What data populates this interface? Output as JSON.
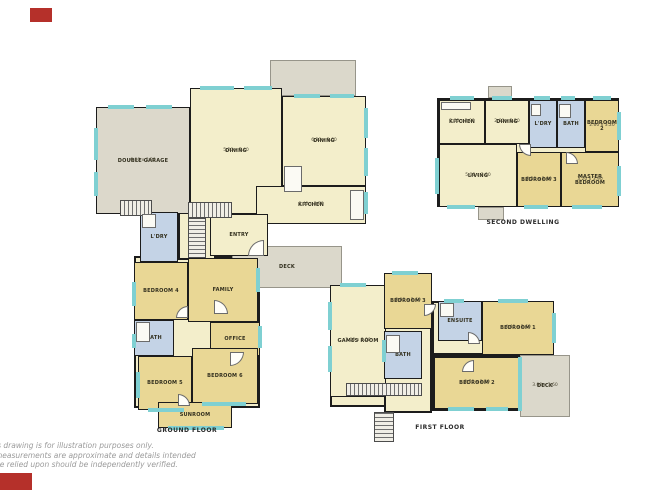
{
  "colors": {
    "wall": "#1c1c1c",
    "living": "#f3eecb",
    "bed": "#e9d795",
    "wet": "#c4d3e6",
    "garage": "#dcd8cb",
    "deck": "#dbd8cb",
    "window": "#7fd0d2",
    "brand": "#b5302a"
  },
  "disclaimer": {
    "line1": "is drawing is for illustration purposes only.",
    "line2": "measurements are approximate and details intended",
    "line3": "be relied upon should be independently verified."
  },
  "plans": {
    "ground": {
      "caption": "GROUND FLOOR",
      "base": [
        [
          134,
          256,
          126,
          152
        ],
        [
          178,
          212,
          38,
          48
        ]
      ],
      "rooms": [
        {
          "type": "deck",
          "rect": [
            270,
            60,
            86,
            36
          ]
        },
        {
          "label": "DECK",
          "type": "deck",
          "rect": [
            232,
            246,
            110,
            42
          ]
        },
        {
          "label": "DOUBLE GARAGE",
          "dims": "6.00 x 8.20",
          "type": "garage",
          "rect": [
            96,
            107,
            94,
            107
          ]
        },
        {
          "label": "DINING",
          "dims": "5.20 x 7.40",
          "type": "living",
          "rect": [
            190,
            88,
            92,
            126
          ]
        },
        {
          "label": "DINING",
          "dims": "6.30 x 3.60",
          "type": "living",
          "rect": [
            282,
            96,
            84,
            90
          ]
        },
        {
          "label": "KITCHEN",
          "dims": "6.40 x 3.70",
          "type": "living",
          "rect": [
            256,
            186,
            110,
            38
          ]
        },
        {
          "label": "ENTRY",
          "type": "living",
          "rect": [
            210,
            214,
            58,
            42
          ]
        },
        {
          "label": "L'DRY",
          "type": "wet",
          "rect": [
            140,
            212,
            38,
            50
          ]
        },
        {
          "label": "BEDROOM 4",
          "type": "bed",
          "rect": [
            134,
            262,
            54,
            58
          ]
        },
        {
          "label": "FAMILY",
          "type": "bed",
          "rect": [
            188,
            258,
            70,
            64
          ]
        },
        {
          "label": "BATH",
          "type": "wet",
          "rect": [
            134,
            320,
            40,
            36
          ]
        },
        {
          "label": "OFFICE",
          "type": "bed",
          "rect": [
            210,
            322,
            50,
            34
          ]
        },
        {
          "label": "BEDROOM 5",
          "type": "bed",
          "rect": [
            138,
            356,
            54,
            54
          ]
        },
        {
          "label": "BEDROOM 6",
          "type": "bed",
          "rect": [
            192,
            348,
            66,
            56
          ]
        },
        {
          "label": "SUNROOM",
          "type": "bed",
          "rect": [
            158,
            402,
            74,
            26
          ]
        }
      ],
      "stairs": [
        [
          120,
          200,
          32,
          16,
          "v"
        ],
        [
          188,
          202,
          44,
          16,
          "v"
        ],
        [
          188,
          218,
          18,
          40,
          "h"
        ]
      ],
      "windows": [
        [
          108,
          105,
          26,
          4
        ],
        [
          146,
          105,
          26,
          4
        ],
        [
          94,
          128,
          4,
          32
        ],
        [
          94,
          172,
          4,
          24
        ],
        [
          200,
          86,
          34,
          4
        ],
        [
          244,
          86,
          28,
          4
        ],
        [
          294,
          94,
          26,
          4
        ],
        [
          330,
          94,
          24,
          4
        ],
        [
          364,
          108,
          4,
          30
        ],
        [
          364,
          148,
          4,
          28
        ],
        [
          364,
          192,
          4,
          22
        ],
        [
          132,
          282,
          4,
          24
        ],
        [
          132,
          334,
          4,
          14
        ],
        [
          136,
          372,
          4,
          26
        ],
        [
          256,
          268,
          4,
          24
        ],
        [
          258,
          326,
          4,
          22
        ],
        [
          148,
          408,
          36,
          4
        ],
        [
          202,
          402,
          44,
          4
        ],
        [
          168,
          426,
          56,
          4
        ]
      ],
      "fixtures": [
        [
          284,
          166,
          18,
          26
        ],
        [
          350,
          190,
          14,
          30
        ],
        [
          136,
          322,
          14,
          20
        ],
        [
          142,
          214,
          14,
          14
        ]
      ],
      "doors": [
        [
          248,
          240,
          16,
          16,
          "nw"
        ],
        [
          214,
          300,
          14,
          14,
          "ne"
        ],
        [
          176,
          306,
          12,
          12,
          "nw"
        ],
        [
          230,
          352,
          14,
          14,
          "se"
        ],
        [
          178,
          394,
          12,
          12,
          "ne"
        ]
      ]
    },
    "second": {
      "caption": "SECOND DWELLING",
      "base": [
        [
          437,
          98,
          182,
          109
        ]
      ],
      "rooms": [
        {
          "type": "deck",
          "rect": [
            488,
            86,
            24,
            12
          ]
        },
        {
          "type": "deck",
          "rect": [
            478,
            207,
            26,
            13
          ]
        },
        {
          "label": "KITCHEN",
          "dims": "2.60 x 2.90",
          "type": "living",
          "rect": [
            439,
            100,
            46,
            44
          ]
        },
        {
          "label": "DINING",
          "dims": "2.60 x 2.20",
          "type": "living",
          "rect": [
            485,
            100,
            44,
            44
          ]
        },
        {
          "label": "L'DRY",
          "type": "wet",
          "rect": [
            529,
            100,
            28,
            48
          ]
        },
        {
          "label": "BATH",
          "type": "wet",
          "rect": [
            557,
            100,
            28,
            48
          ]
        },
        {
          "label": "BEDROOM 2",
          "dims": "2.60 x 3.20",
          "type": "bed",
          "rect": [
            585,
            100,
            34,
            52
          ]
        },
        {
          "label": "LIVING",
          "dims": "5.00 x 3.90",
          "type": "living",
          "rect": [
            439,
            144,
            78,
            63
          ]
        },
        {
          "label": "BEDROOM 3",
          "dims": "3.20 x 3.00",
          "type": "bed",
          "rect": [
            517,
            152,
            44,
            55
          ]
        },
        {
          "label": "MASTER BEDROOM",
          "dims": "3.20 x 3.90",
          "type": "bed",
          "rect": [
            561,
            152,
            58,
            55
          ]
        }
      ],
      "stairs": [],
      "windows": [
        [
          450,
          96,
          24,
          4
        ],
        [
          492,
          96,
          20,
          4
        ],
        [
          534,
          96,
          16,
          4
        ],
        [
          561,
          96,
          14,
          4
        ],
        [
          593,
          96,
          18,
          4
        ],
        [
          435,
          158,
          4,
          36
        ],
        [
          617,
          112,
          4,
          28
        ],
        [
          617,
          166,
          4,
          30
        ],
        [
          447,
          205,
          28,
          4
        ],
        [
          524,
          205,
          24,
          4
        ],
        [
          572,
          205,
          30,
          4
        ]
      ],
      "fixtures": [
        [
          441,
          102,
          30,
          8
        ],
        [
          559,
          104,
          12,
          14
        ],
        [
          531,
          104,
          10,
          12
        ]
      ],
      "doors": [
        [
          519,
          144,
          12,
          12,
          "sw"
        ],
        [
          566,
          152,
          12,
          12,
          "ne"
        ]
      ]
    },
    "first": {
      "caption": "FIRST FLOOR",
      "base": [
        [
          330,
          285,
          56,
          122
        ],
        [
          384,
          273,
          48,
          140
        ],
        [
          432,
          301,
          122,
          54
        ],
        [
          432,
          355,
          88,
          56
        ]
      ],
      "rooms": [
        {
          "label": "DECK",
          "dims": "3.00 x 3.60",
          "type": "deck",
          "rect": [
            520,
            355,
            50,
            62
          ]
        },
        {
          "label": "GAMES ROOM",
          "dims": "3.00 x 8.00",
          "type": "living",
          "rect": [
            330,
            285,
            56,
            112
          ]
        },
        {
          "label": "BEDROOM 3",
          "dims": "3.00 x 3.60",
          "type": "bed",
          "rect": [
            384,
            273,
            48,
            56
          ]
        },
        {
          "label": "ENSUITE",
          "type": "wet",
          "rect": [
            438,
            301,
            44,
            40
          ]
        },
        {
          "label": "BEDROOM 1",
          "dims": "4.40 x 3.60",
          "type": "bed",
          "rect": [
            482,
            301,
            72,
            54
          ]
        },
        {
          "label": "BATH",
          "type": "wet",
          "rect": [
            384,
            331,
            38,
            48
          ]
        },
        {
          "label": "BEDROOM 2",
          "dims": "3.70 x 3.20",
          "type": "bed",
          "rect": [
            434,
            357,
            86,
            52
          ]
        }
      ],
      "stairs": [
        [
          346,
          383,
          76,
          13,
          "v"
        ],
        [
          374,
          412,
          20,
          30,
          "h"
        ]
      ],
      "windows": [
        [
          340,
          283,
          26,
          4
        ],
        [
          392,
          271,
          26,
          4
        ],
        [
          328,
          302,
          4,
          28
        ],
        [
          328,
          346,
          4,
          26
        ],
        [
          444,
          299,
          20,
          4
        ],
        [
          498,
          299,
          30,
          4
        ],
        [
          552,
          313,
          4,
          30
        ],
        [
          448,
          407,
          26,
          4
        ],
        [
          486,
          407,
          22,
          4
        ],
        [
          382,
          340,
          4,
          22
        ],
        [
          518,
          357,
          4,
          54
        ]
      ],
      "fixtures": [
        [
          440,
          303,
          14,
          14
        ],
        [
          386,
          335,
          14,
          18
        ]
      ],
      "doors": [
        [
          424,
          304,
          12,
          12,
          "se"
        ],
        [
          468,
          332,
          12,
          12,
          "ne"
        ],
        [
          462,
          360,
          12,
          12,
          "nw"
        ]
      ]
    }
  }
}
